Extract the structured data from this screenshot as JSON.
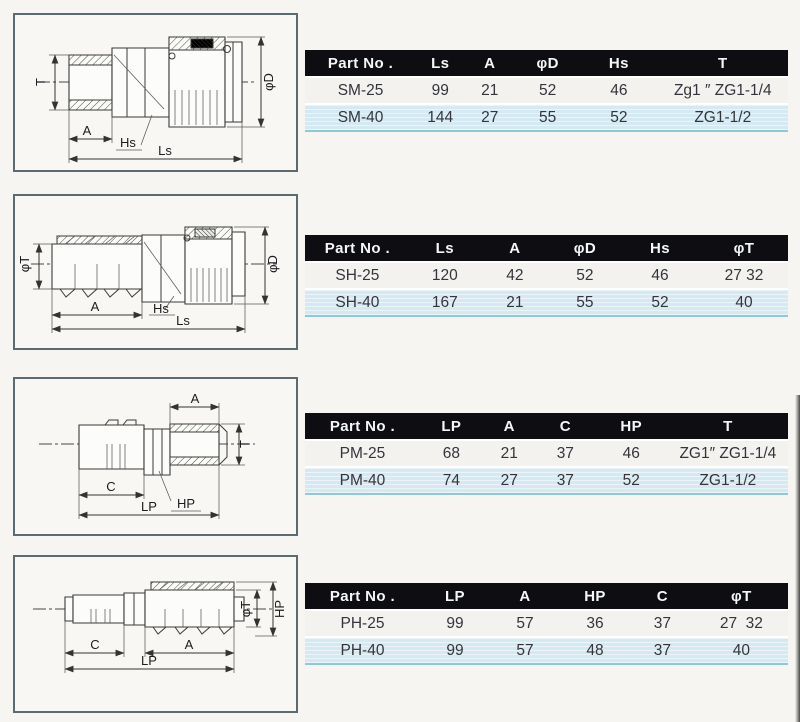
{
  "colors": {
    "page_bg": "#f6f5f2",
    "box_bg": "#f8f7f4",
    "box_border": "#5c6a72",
    "header_bg": "#0e0e12",
    "header_text": "#f4f7f9",
    "row_light": "#f3f2ef",
    "row_blue": "#d5e9f2",
    "table_bottom": "#8ec9da",
    "ink": "#34343c"
  },
  "sections": [
    {
      "id": "SM",
      "drawing": {
        "labels": {
          "t": "T",
          "d": "φD",
          "a": "A",
          "h": "Hs",
          "l": "Ls"
        }
      },
      "table": {
        "headers": [
          "Part No .",
          "Ls",
          "A",
          "φD",
          "Hs",
          "T"
        ],
        "rows": [
          [
            "SM-25",
            "99",
            "21",
            "52",
            "46",
            "Zg1 ″ ZG1-1/4"
          ],
          [
            "SM-40",
            "144",
            "27",
            "55",
            "52",
            "ZG1-1/2"
          ]
        ]
      }
    },
    {
      "id": "SH",
      "drawing": {
        "labels": {
          "t": "φT",
          "d": "φD",
          "a": "A",
          "h": "Hs",
          "l": "Ls"
        }
      },
      "table": {
        "headers": [
          "Part No .",
          "Ls",
          "A",
          "φD",
          "Hs",
          "φT"
        ],
        "rows": [
          [
            "SH-25",
            "120",
            "42",
            "52",
            "46",
            "27 32"
          ],
          [
            "SH-40",
            "167",
            "21",
            "55",
            "52",
            "40"
          ]
        ]
      }
    },
    {
      "id": "PM",
      "drawing": {
        "labels": {
          "a": "A",
          "t": "T",
          "c": "C",
          "h": "HP",
          "l": "LP"
        }
      },
      "table": {
        "headers": [
          "Part No .",
          "LP",
          "A",
          "C",
          "HP",
          "T"
        ],
        "rows": [
          [
            "PM-25",
            "68",
            "21",
            "37",
            "46",
            "ZG1″ ZG1-1/4"
          ],
          [
            "PM-40",
            "74",
            "27",
            "37",
            "52",
            "ZG1-1/2"
          ]
        ]
      }
    },
    {
      "id": "PH",
      "drawing": {
        "labels": {
          "t": "φT",
          "hp": "HP",
          "c": "C",
          "a": "A",
          "l": "LP"
        }
      },
      "table": {
        "headers": [
          "Part No .",
          "LP",
          "A",
          "HP",
          "C",
          "φT"
        ],
        "rows": [
          [
            "PH-25",
            "99",
            "57",
            "36",
            "37",
            "27  32"
          ],
          [
            "PH-40",
            "99",
            "57",
            "48",
            "37",
            "40"
          ]
        ]
      }
    }
  ]
}
